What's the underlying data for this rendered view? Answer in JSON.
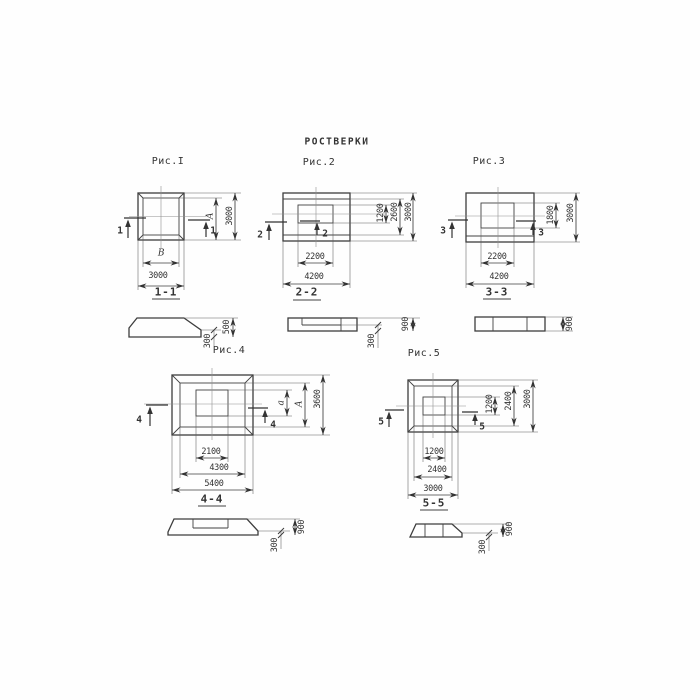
{
  "page": {
    "title": "РОСТВЕРКИ"
  },
  "colors": {
    "ink": "#3d3d3d",
    "paper": "#fefefe"
  },
  "figures": [
    {
      "caption": "Рис.I",
      "mark": "1",
      "section_title": "1-1",
      "dim_right_inner": "А",
      "dim_right_outer": "3000",
      "dim_bottom_inner": "В",
      "dim_bottom_outer": "3000",
      "sec_total": "500",
      "sec_edge": "300"
    },
    {
      "caption": "Рис.2",
      "mark": "2",
      "section_title": "2-2",
      "dim_right_inner": "1200",
      "dim_right_mid": "2600",
      "dim_right_outer": "3000",
      "dim_bottom_inner": "2200",
      "dim_bottom_outer": "4200",
      "sec_total": "900",
      "sec_edge": "300"
    },
    {
      "caption": "Рис.3",
      "mark": "3",
      "section_title": "3-3",
      "dim_right_inner": "1800",
      "dim_right_outer": "3000",
      "dim_bottom_inner": "2200",
      "dim_bottom_outer": "4200",
      "sec_total": "900"
    },
    {
      "caption": "Рис.4",
      "mark": "4",
      "section_title": "4-4",
      "dim_right_inner": "а",
      "dim_right_mid": "А",
      "dim_right_outer": "3600",
      "dim_bottom_inner": "2100",
      "dim_bottom_mid": "4300",
      "dim_bottom_outer": "5400",
      "sec_total": "900",
      "sec_edge": "300"
    },
    {
      "caption": "Рис.5",
      "mark": "5",
      "section_title": "5-5",
      "dim_right_inner": "1200",
      "dim_right_mid": "2400",
      "dim_right_outer": "3000",
      "dim_bottom_inner": "1200",
      "dim_bottom_mid": "2400",
      "dim_bottom_outer": "3000",
      "sec_total": "900",
      "sec_edge": "300"
    }
  ]
}
